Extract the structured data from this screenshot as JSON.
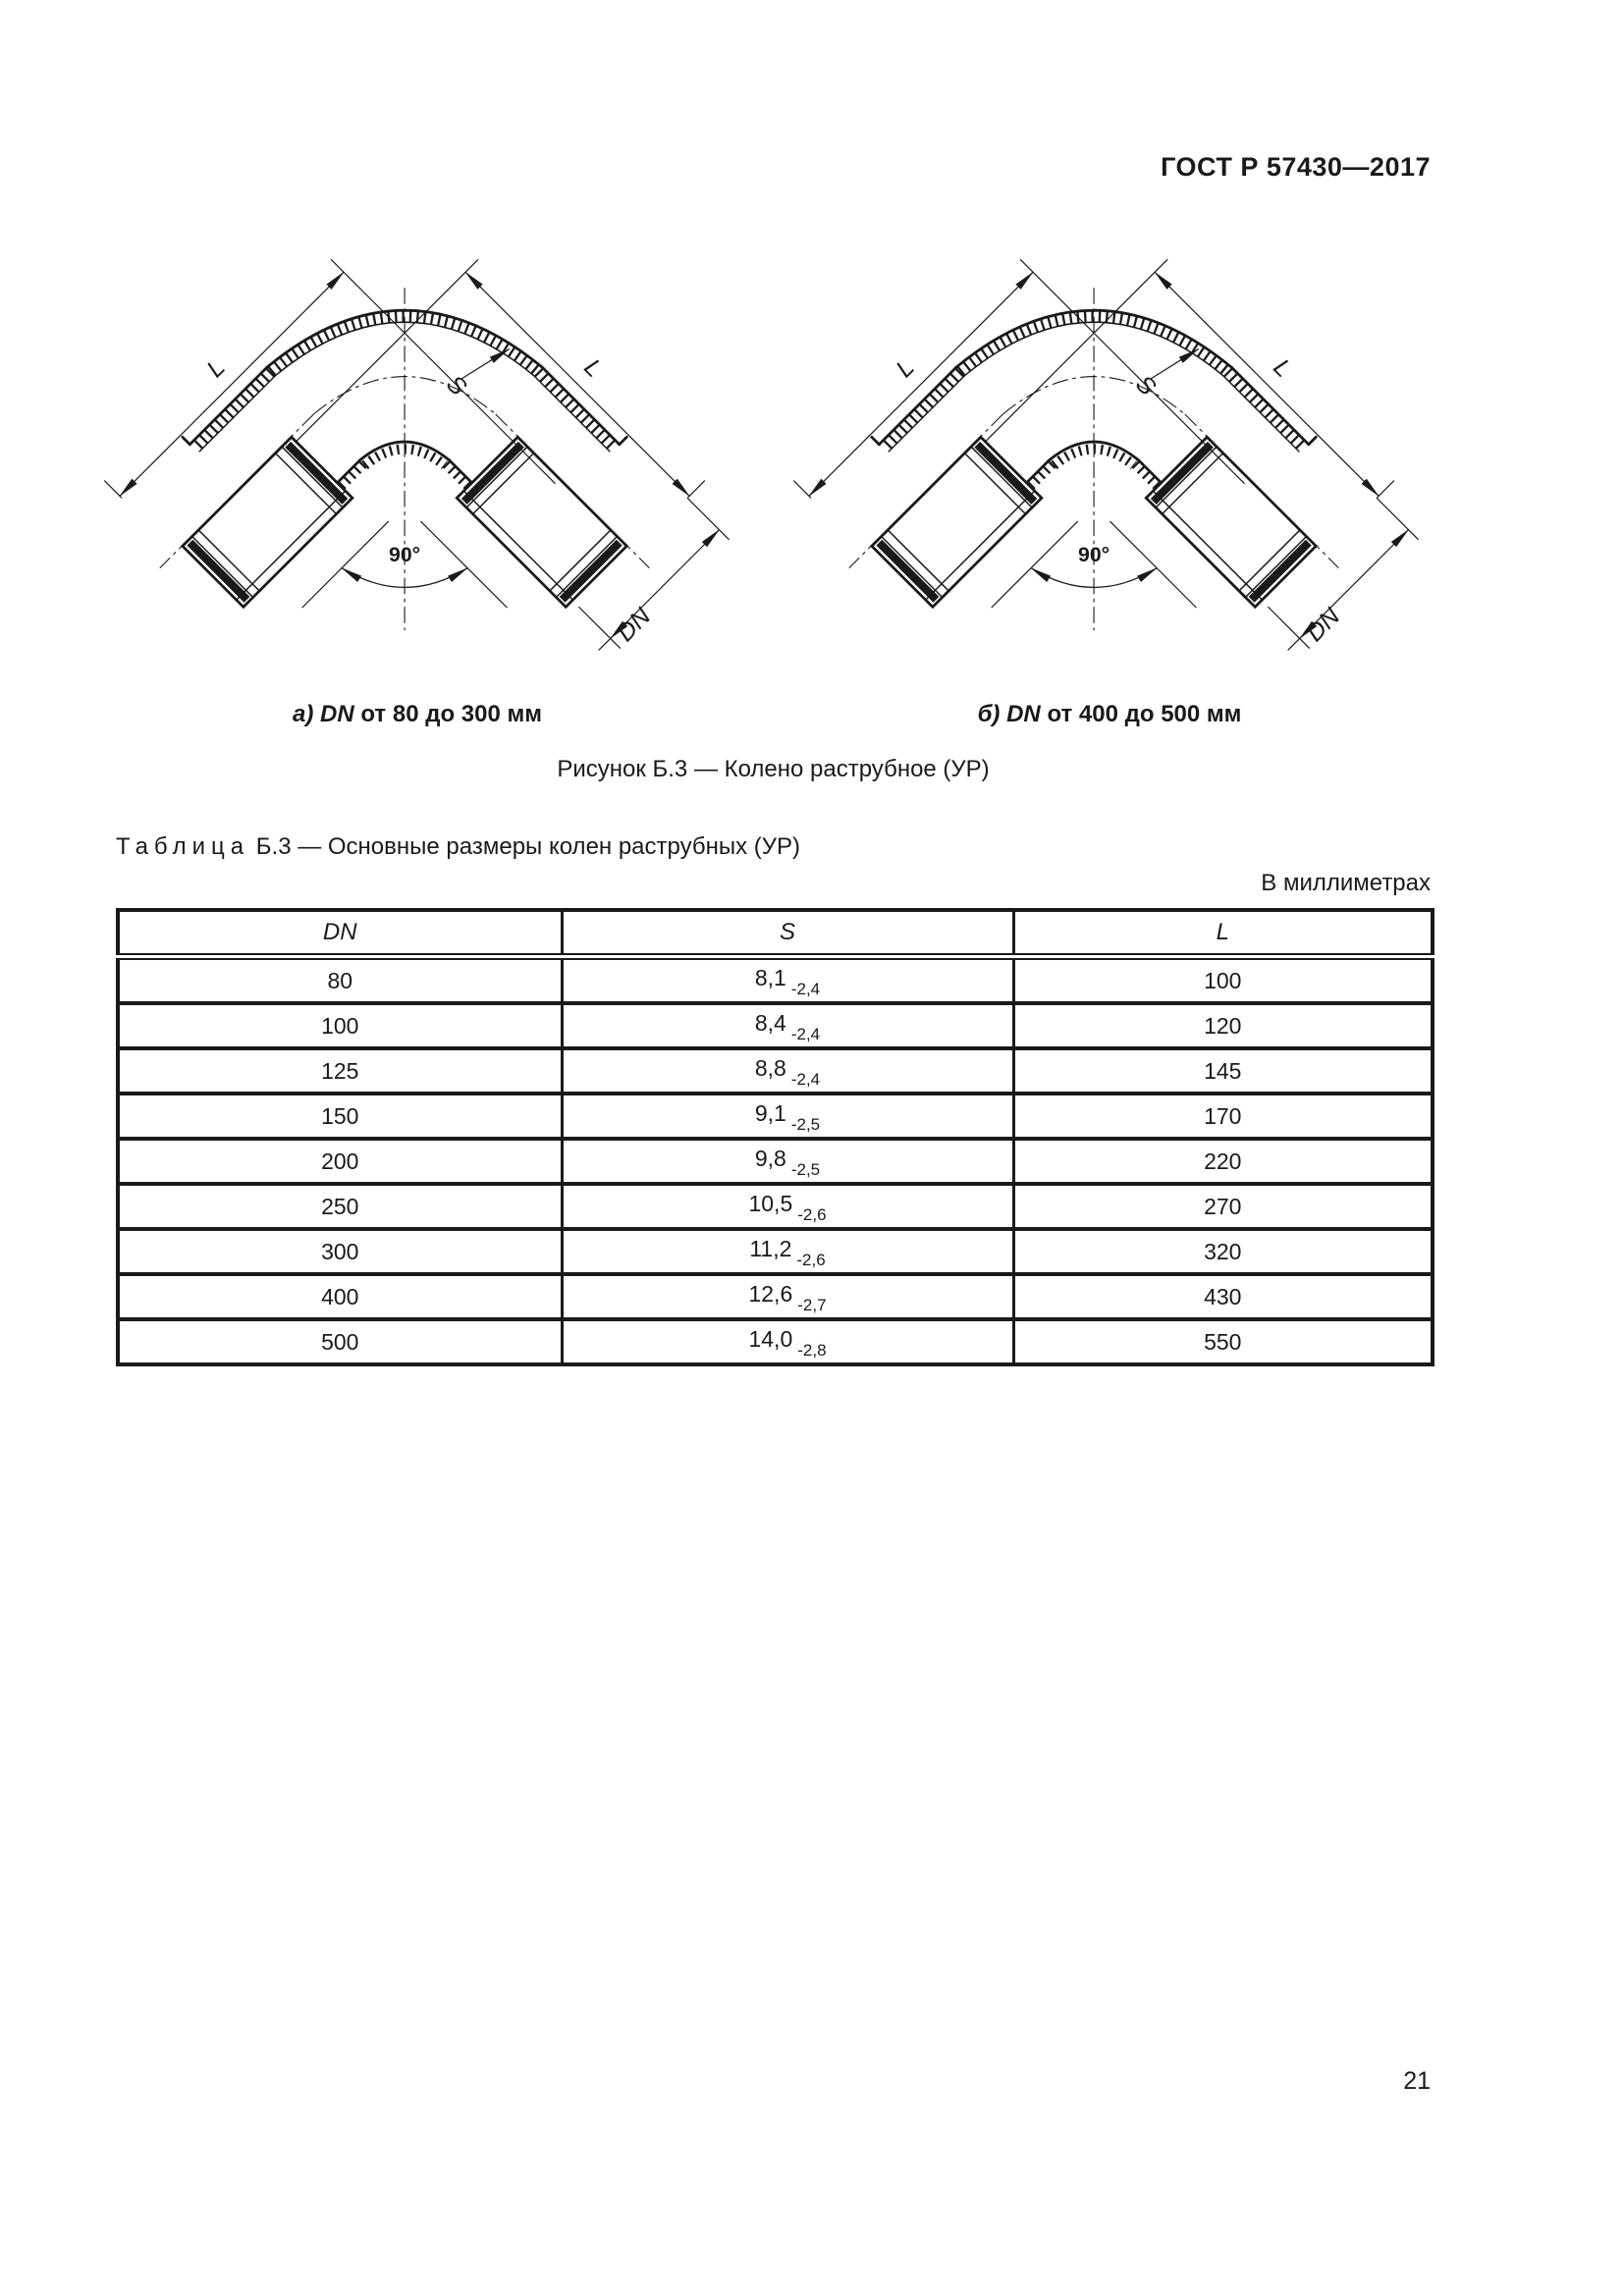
{
  "page": {
    "standard_code": "ГОСТ Р 57430—2017",
    "page_number": "21"
  },
  "figure": {
    "caption_a": {
      "prefix": "а)",
      "dn": "DN",
      "rest": "от 80 до 300 мм"
    },
    "caption_b": {
      "prefix": "б)",
      "dn": "DN",
      "rest": "от 400 до 500 мм"
    },
    "figure_caption": "Рисунок Б.3 — Колено раструбное (УР)",
    "labels": {
      "length": "L",
      "thickness": "S",
      "diameter": "DN",
      "angle": "90°"
    }
  },
  "table": {
    "caption_word": "Таблица",
    "caption_number": "Б.3",
    "caption_title": "— Основные размеры колен раструбных (УР)",
    "units_note": "В миллиметрах",
    "columns": [
      "DN",
      "S",
      "L"
    ],
    "rows": [
      {
        "dn": "80",
        "s": "8,1",
        "s_tol": "-2,4",
        "l": "100"
      },
      {
        "dn": "100",
        "s": "8,4",
        "s_tol": "-2,4",
        "l": "120"
      },
      {
        "dn": "125",
        "s": "8,8",
        "s_tol": "-2,4",
        "l": "145"
      },
      {
        "dn": "150",
        "s": "9,1",
        "s_tol": "-2,5",
        "l": "170"
      },
      {
        "dn": "200",
        "s": "9,8",
        "s_tol": "-2,5",
        "l": "220"
      },
      {
        "dn": "250",
        "s": "10,5",
        "s_tol": "-2,6",
        "l": "270"
      },
      {
        "dn": "300",
        "s": "11,2",
        "s_tol": "-2,6",
        "l": "320"
      },
      {
        "dn": "400",
        "s": "12,6",
        "s_tol": "-2,7",
        "l": "430"
      },
      {
        "dn": "500",
        "s": "14,0",
        "s_tol": "-2,8",
        "l": "550"
      }
    ]
  }
}
